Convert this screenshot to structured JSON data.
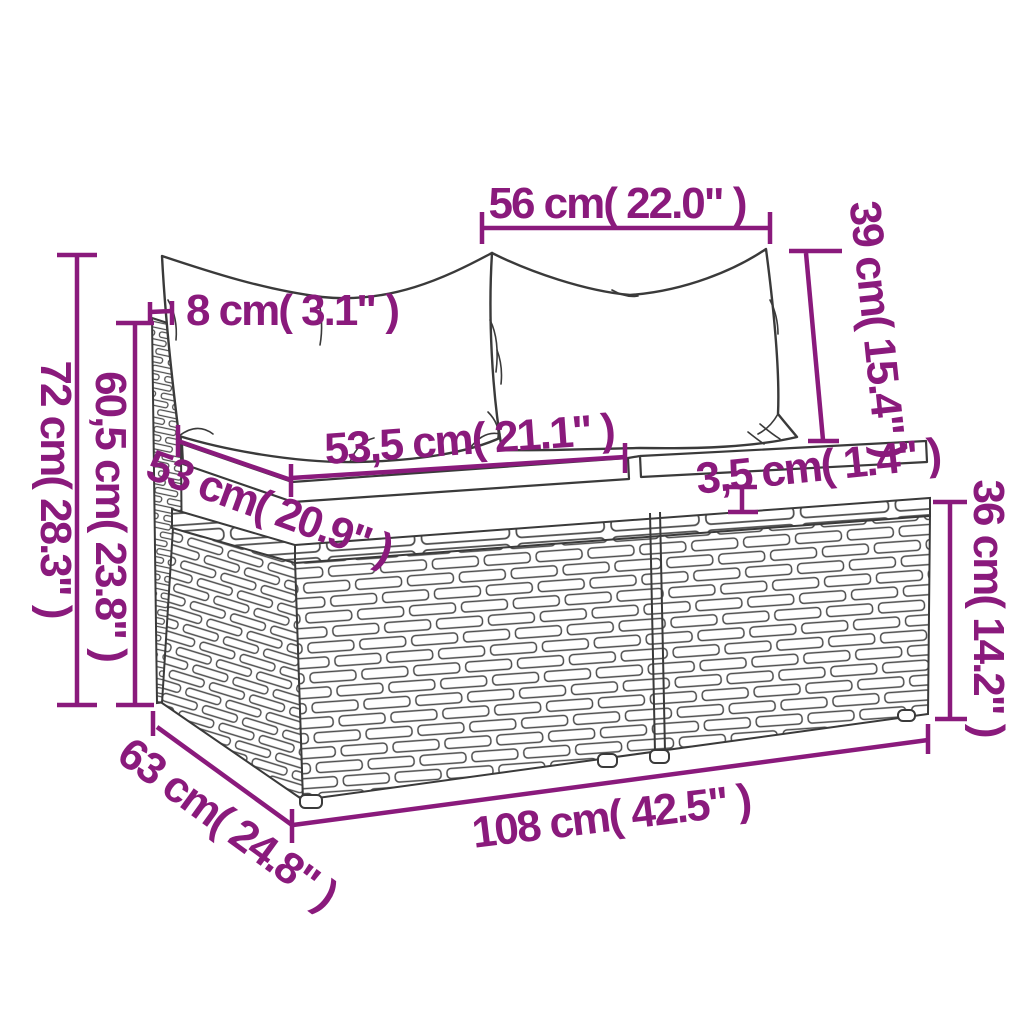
{
  "diagram": {
    "type": "product-dimension-diagram",
    "subject": "poly rattan garden sofa 2-seat middle sections with cushions",
    "colors": {
      "dimension_accent": "#8a1a7c",
      "line_art": "#3a3a3a",
      "background": "#ffffff"
    }
  },
  "dimensions": {
    "pillow_width": {
      "label": "56 cm( 22.0\" )"
    },
    "pillow_height": {
      "label": "39 cm( 15.4\" )"
    },
    "back_thickness": {
      "label": "8 cm( 3.1\" )"
    },
    "total_height": {
      "label": "72 cm( 28.3\" )"
    },
    "back_height": {
      "label": "60,5 cm( 23.8\" )"
    },
    "seat_depth": {
      "label": "53 cm( 20.9\" )"
    },
    "seat_width": {
      "label": "53,5 cm( 21.1\" )"
    },
    "cushion_thickness": {
      "label": "3,5 cm( 1.4\" )"
    },
    "base_height": {
      "label": "36 cm( 14.2\" )"
    },
    "total_depth": {
      "label": "63 cm( 24.8\" )"
    },
    "total_width": {
      "label": "108 cm( 42.5\" )"
    }
  }
}
